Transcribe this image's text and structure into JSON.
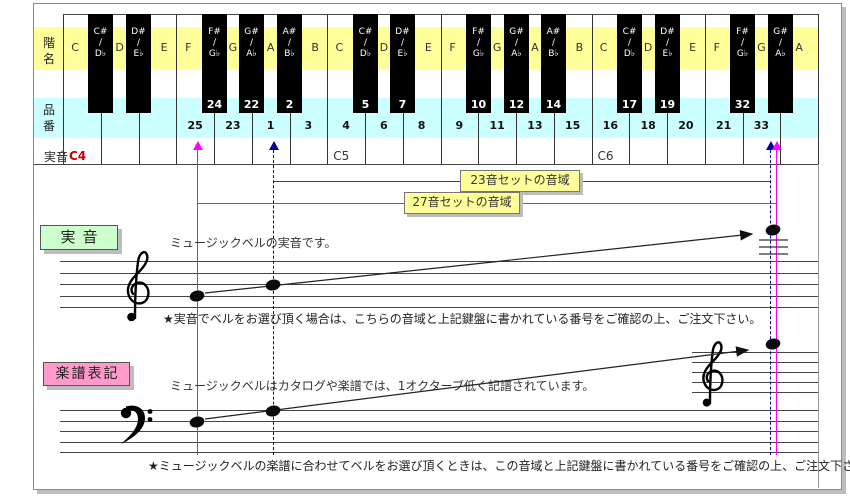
{
  "colors": {
    "band_scale": "#ffff99",
    "band_product": "#ccffff",
    "range23": "#3333cc",
    "range27": "#ff00ff",
    "guide_navy": "#000099",
    "guide_magenta": "#ff00ff",
    "sound_c4": "#cc0000",
    "box_actual_bg": "#ccffcc",
    "box_notation_bg": "#ff99cc",
    "range_label_bg": "#ffff99"
  },
  "keyboard": {
    "row_labels": {
      "scale": "階名",
      "product": "品番",
      "sound": "実音"
    },
    "octaves": [
      {
        "sound_label": "C4",
        "sound_color": "#cc0000",
        "white_keys": [
          {
            "note": "C",
            "num": ""
          },
          {
            "note": "D",
            "num": ""
          },
          {
            "note": "E",
            "num": ""
          },
          {
            "note": "F",
            "num": "25"
          },
          {
            "note": "G",
            "num": "23"
          },
          {
            "note": "A",
            "num": "1"
          },
          {
            "note": "B",
            "num": "3"
          }
        ],
        "black_keys": [
          {
            "sharp": "C#",
            "flat": "D♭",
            "num": ""
          },
          {
            "sharp": "D#",
            "flat": "E♭",
            "num": ""
          },
          {
            "sharp": "F#",
            "flat": "G♭",
            "num": "24"
          },
          {
            "sharp": "G#",
            "flat": "A♭",
            "num": "22"
          },
          {
            "sharp": "A#",
            "flat": "B♭",
            "num": "2"
          }
        ]
      },
      {
        "sound_label": "C5",
        "sound_color": "#333333",
        "white_keys": [
          {
            "note": "C",
            "num": "4"
          },
          {
            "note": "D",
            "num": "6"
          },
          {
            "note": "E",
            "num": "8"
          },
          {
            "note": "F",
            "num": "9"
          },
          {
            "note": "G",
            "num": "11"
          },
          {
            "note": "A",
            "num": "13"
          },
          {
            "note": "B",
            "num": "15"
          }
        ],
        "black_keys": [
          {
            "sharp": "C#",
            "flat": "D♭",
            "num": "5"
          },
          {
            "sharp": "D#",
            "flat": "E♭",
            "num": "7"
          },
          {
            "sharp": "F#",
            "flat": "G♭",
            "num": "10"
          },
          {
            "sharp": "G#",
            "flat": "A♭",
            "num": "12"
          },
          {
            "sharp": "A#",
            "flat": "B♭",
            "num": "14"
          }
        ]
      },
      {
        "sound_label": "C6",
        "sound_color": "#333333",
        "white_keys": [
          {
            "note": "C",
            "num": "16"
          },
          {
            "note": "D",
            "num": "18"
          },
          {
            "note": "E",
            "num": "20"
          },
          {
            "note": "F",
            "num": "21"
          },
          {
            "note": "G",
            "num": "33"
          },
          {
            "note": "A",
            "num": ""
          }
        ],
        "black_keys": [
          {
            "sharp": "C#",
            "flat": "D♭",
            "num": "17"
          },
          {
            "sharp": "D#",
            "flat": "E♭",
            "num": "19"
          },
          {
            "sharp": "F#",
            "flat": "G♭",
            "num": "32"
          },
          {
            "sharp": "G#",
            "flat": "A♭",
            "num": ""
          }
        ]
      }
    ]
  },
  "range_lines": [
    {
      "label": "23音セットの音域",
      "color": "#3333cc",
      "y": 181,
      "x1": 273,
      "x2": 770
    },
    {
      "label": "27音セットの音域",
      "color": "#ff00ff",
      "y": 203,
      "x1": 197,
      "x2": 776
    }
  ],
  "guides": [
    {
      "x": 197,
      "color": "#ff00ff",
      "dashed": false
    },
    {
      "x": 273,
      "color": "#000099",
      "dashed": true
    },
    {
      "x": 770,
      "color": "#000099",
      "dashed": true
    },
    {
      "x": 776,
      "color": "#ff00ff",
      "dashed": false
    }
  ],
  "sections": {
    "actual": {
      "box_label": "実音",
      "desc": "ミュージックベルの実音です。",
      "note": "★実音でベルをお選び頂く場合は、こちらの音域と上記鍵盤に書かれている番号をご確認の上、ご注文下さい。"
    },
    "notation": {
      "box_label": "楽譜表記",
      "desc": "ミュージックベルはカタログや楽譜では、1オクターブ低く記譜されています。",
      "note": "★ミュージックベルの楽譜に合わせてベルをお選び頂くときは、この音域と上記鍵盤に書かれている番号をご確認の上、ご注文下さい。"
    }
  }
}
